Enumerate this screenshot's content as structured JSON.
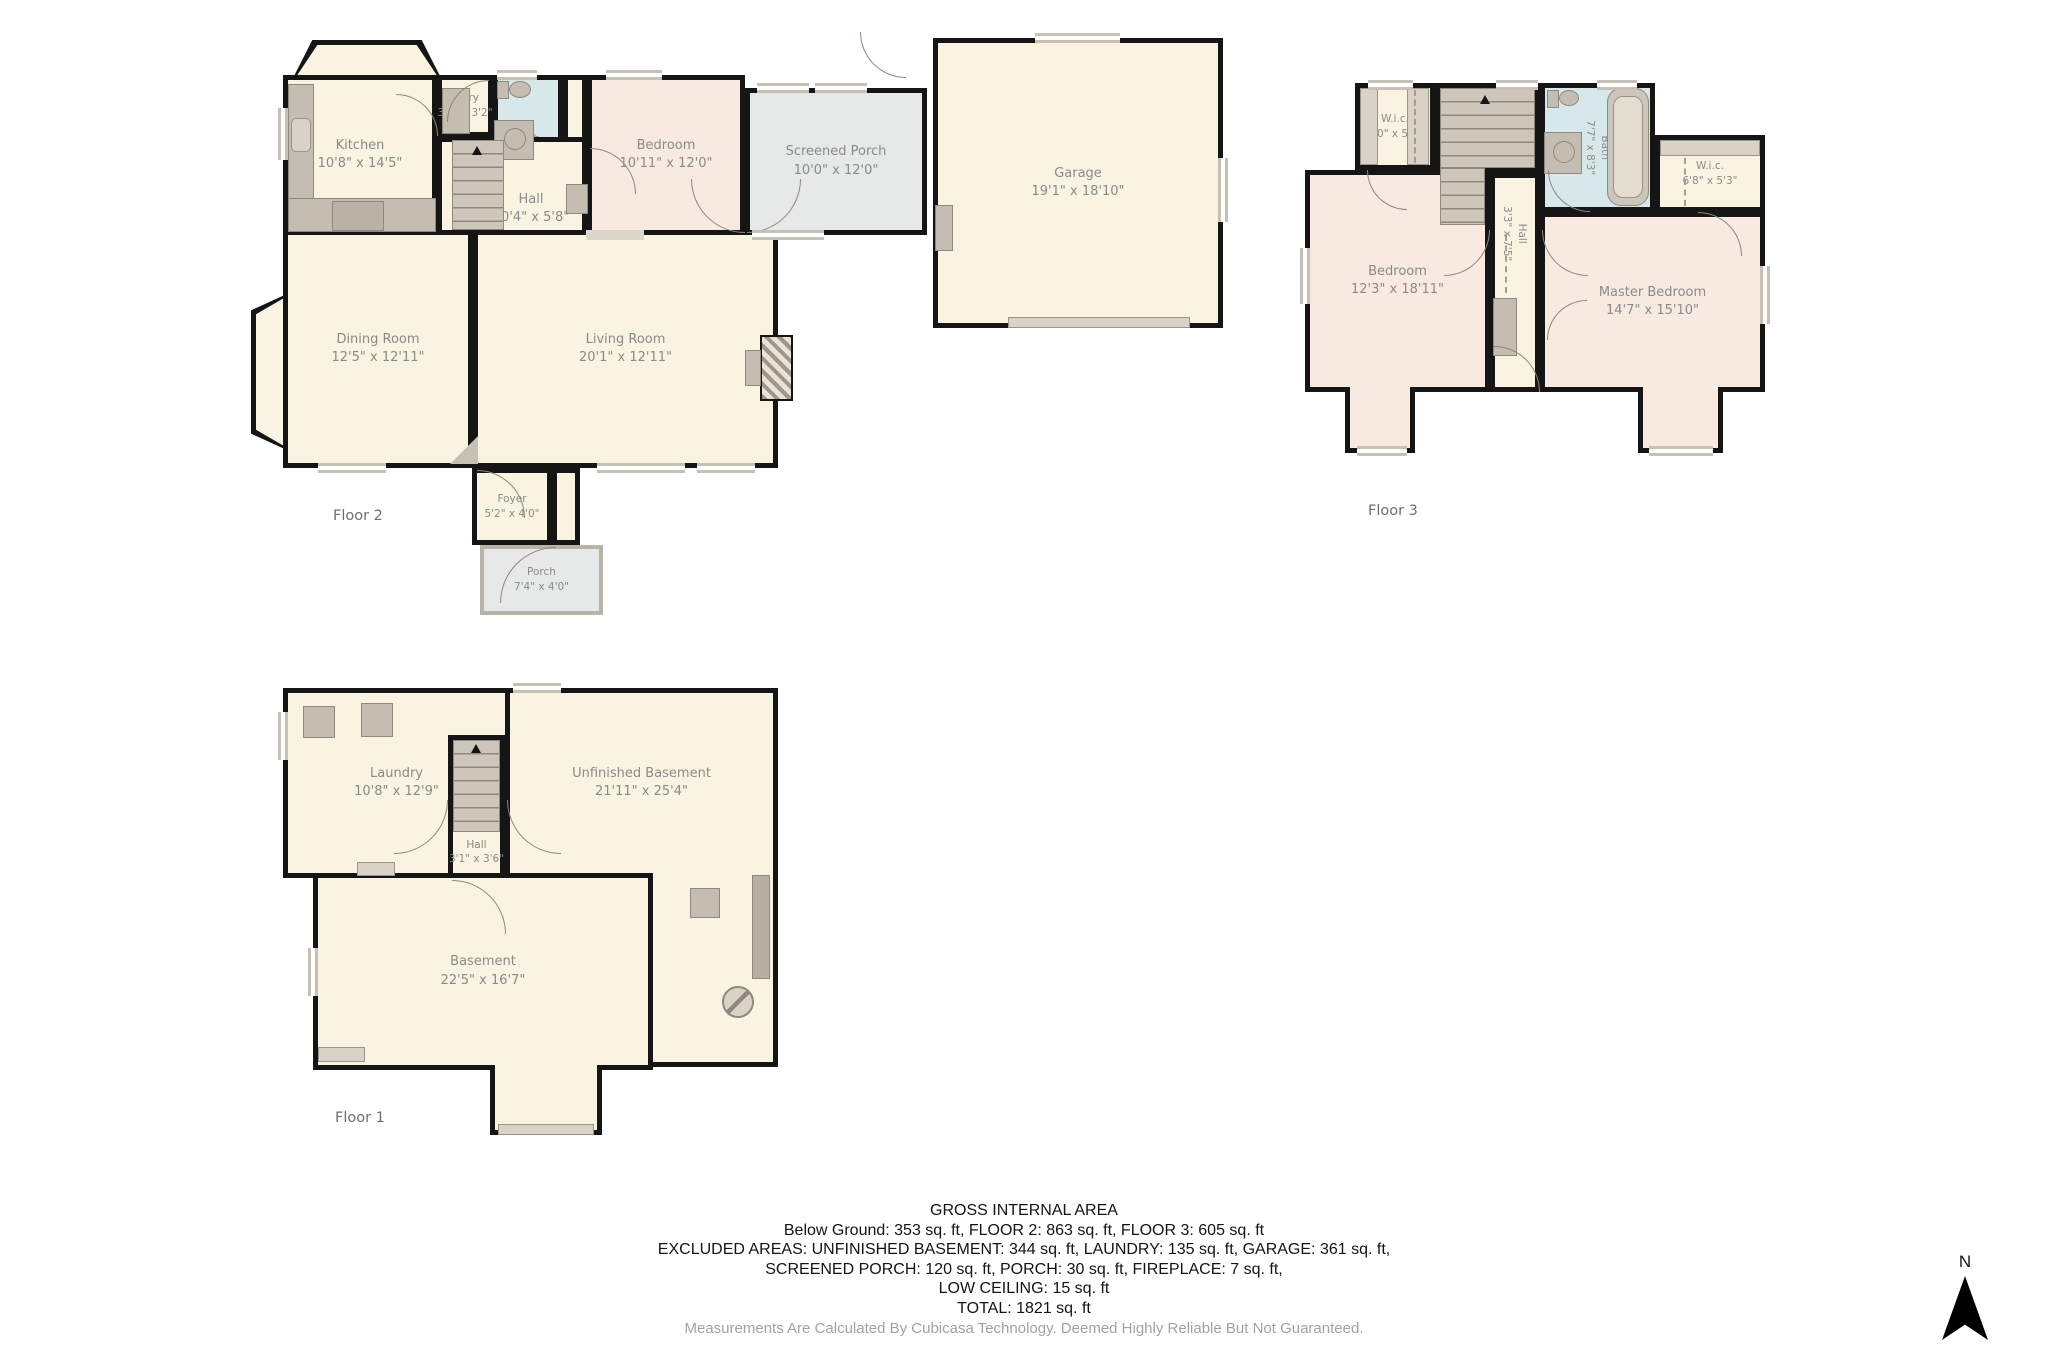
{
  "floors": {
    "f2": {
      "label": "Floor 2",
      "rooms": {
        "kitchen": {
          "name": "Kitchen",
          "dims": "10'8\" x 14'5\""
        },
        "entry": {
          "name": "Entry",
          "dims": "3'1\" x 3'2\""
        },
        "bath": {
          "name": "Bath",
          "dims": "4'0\" x 6'0\""
        },
        "hall": {
          "name": "Hall",
          "dims": "10'4\" x 5'8\""
        },
        "bedroom": {
          "name": "Bedroom",
          "dims": "10'11\" x 12'0\""
        },
        "sporch": {
          "name": "Screened Porch",
          "dims": "10'0\" x 12'0\""
        },
        "garage": {
          "name": "Garage",
          "dims": "19'1\" x 18'10\""
        },
        "dining": {
          "name": "Dining Room",
          "dims": "12'5\" x 12'11\""
        },
        "living": {
          "name": "Living Room",
          "dims": "20'1\" x 12'11\""
        },
        "foyer": {
          "name": "Foyer",
          "dims": "5'2\" x 4'0\""
        },
        "porch": {
          "name": "Porch",
          "dims": "7'4\" x 4'0\""
        }
      }
    },
    "f3": {
      "label": "Floor 3",
      "rooms": {
        "wic_left": {
          "name": "W.i.c.",
          "dims": "5'0\" x 5'2\""
        },
        "bath": {
          "name": "Bath",
          "dims": "7'7\" x 8'3\""
        },
        "hall": {
          "name": "Hall",
          "dims": "3'3\" x 7'5\""
        },
        "wic_right": {
          "name": "W.i.c.",
          "dims": "6'8\" x 5'3\""
        },
        "bedroom": {
          "name": "Bedroom",
          "dims": "12'3\" x 18'11\""
        },
        "master": {
          "name": "Master Bedroom",
          "dims": "14'7\" x 15'10\""
        }
      }
    },
    "f1": {
      "label": "Floor 1",
      "rooms": {
        "laundry": {
          "name": "Laundry",
          "dims": "10'8\" x 12'9\""
        },
        "hall": {
          "name": "Hall",
          "dims": "3'1\" x 3'6\""
        },
        "unfinished": {
          "name": "Unfinished Basement",
          "dims": "21'11\" x 25'4\""
        },
        "basement": {
          "name": "Basement",
          "dims": "22'5\" x 16'7\""
        }
      }
    }
  },
  "summary": {
    "title": "GROSS INTERNAL AREA",
    "line1": "Below Ground: 353 sq. ft, FLOOR 2: 863 sq. ft, FLOOR 3: 605 sq. ft",
    "line2": "EXCLUDED AREAS: UNFINISHED BASEMENT: 344 sq. ft, LAUNDRY: 135 sq. ft, GARAGE: 361 sq. ft,",
    "line3": "SCREENED PORCH: 120 sq. ft, PORCH: 30 sq. ft, FIREPLACE: 7 sq. ft,",
    "line4": "LOW CEILING: 15 sq. ft",
    "line5": "TOTAL: 1821 sq. ft",
    "disclaimer": "Measurements Are Calculated By Cubicasa Technology. Deemed Highly Reliable But Not Guaranteed."
  },
  "compass": {
    "label": "N"
  },
  "colors": {
    "wall": "#151515",
    "room_cream": "#f9f3e1",
    "room_pink": "#f8eae1",
    "bath_blue": "#d7e8ea",
    "porch_gray": "#e7e9e8",
    "fixture_gray": "#c4bdb1",
    "label_gray": "#8a8a8a"
  }
}
